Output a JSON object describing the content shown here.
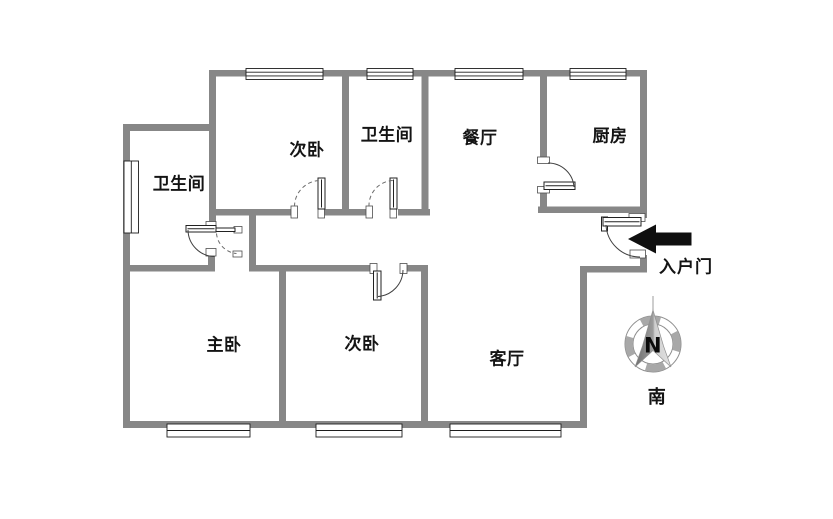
{
  "colors": {
    "wall": "#878787",
    "arrow": "#0f0f0f",
    "text": "#141414"
  },
  "rooms": [
    {
      "name": "bathroom-left",
      "label": "卫生间"
    },
    {
      "name": "bedroom-second-top",
      "label": "次卧"
    },
    {
      "name": "bathroom-top",
      "label": "卫生间"
    },
    {
      "name": "dining-room",
      "label": "餐厅"
    },
    {
      "name": "kitchen",
      "label": "厨房"
    },
    {
      "name": "master-bedroom",
      "label": "主卧"
    },
    {
      "name": "bedroom-second-bottom",
      "label": "次卧"
    },
    {
      "name": "living-room",
      "label": "客厅"
    }
  ],
  "entrance": {
    "label": "入户门"
  },
  "compass": {
    "north": "N",
    "south": "南"
  }
}
